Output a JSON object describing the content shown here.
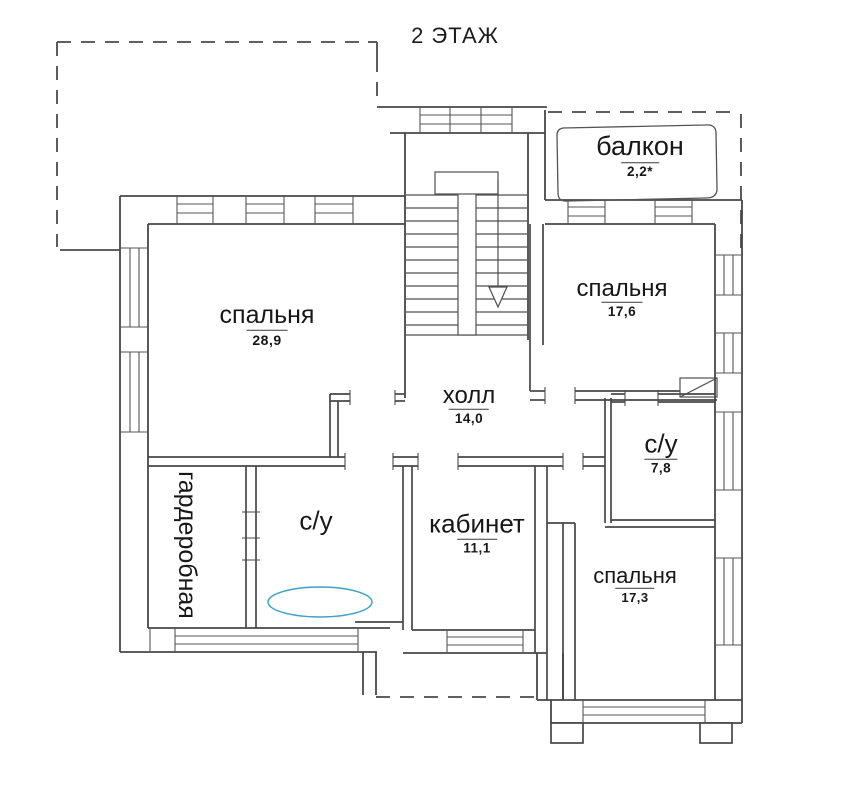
{
  "title": "2 ЭТАЖ",
  "rooms": [
    {
      "id": "balcony",
      "label": "балкон",
      "area": "2,2*"
    },
    {
      "id": "bedroom-main",
      "label": "спальня",
      "area": "28,9"
    },
    {
      "id": "bedroom-right",
      "label": "спальня",
      "area": "17,6"
    },
    {
      "id": "hall",
      "label": "холл",
      "area": "14,0"
    },
    {
      "id": "bathroom-right",
      "label": "с/у",
      "area": "7,8"
    },
    {
      "id": "study",
      "label": "кабинет",
      "area": "11,1"
    },
    {
      "id": "bedroom-bottom",
      "label": "спальня",
      "area": "17,3"
    },
    {
      "id": "bathroom-left",
      "label": "с/у",
      "area": ""
    },
    {
      "id": "wardrobe",
      "label": "гардеробная",
      "area": ""
    }
  ],
  "colors": {
    "wall_line": "#4a4a4a",
    "bath_outline": "#3da0c8",
    "background": "#ffffff"
  }
}
